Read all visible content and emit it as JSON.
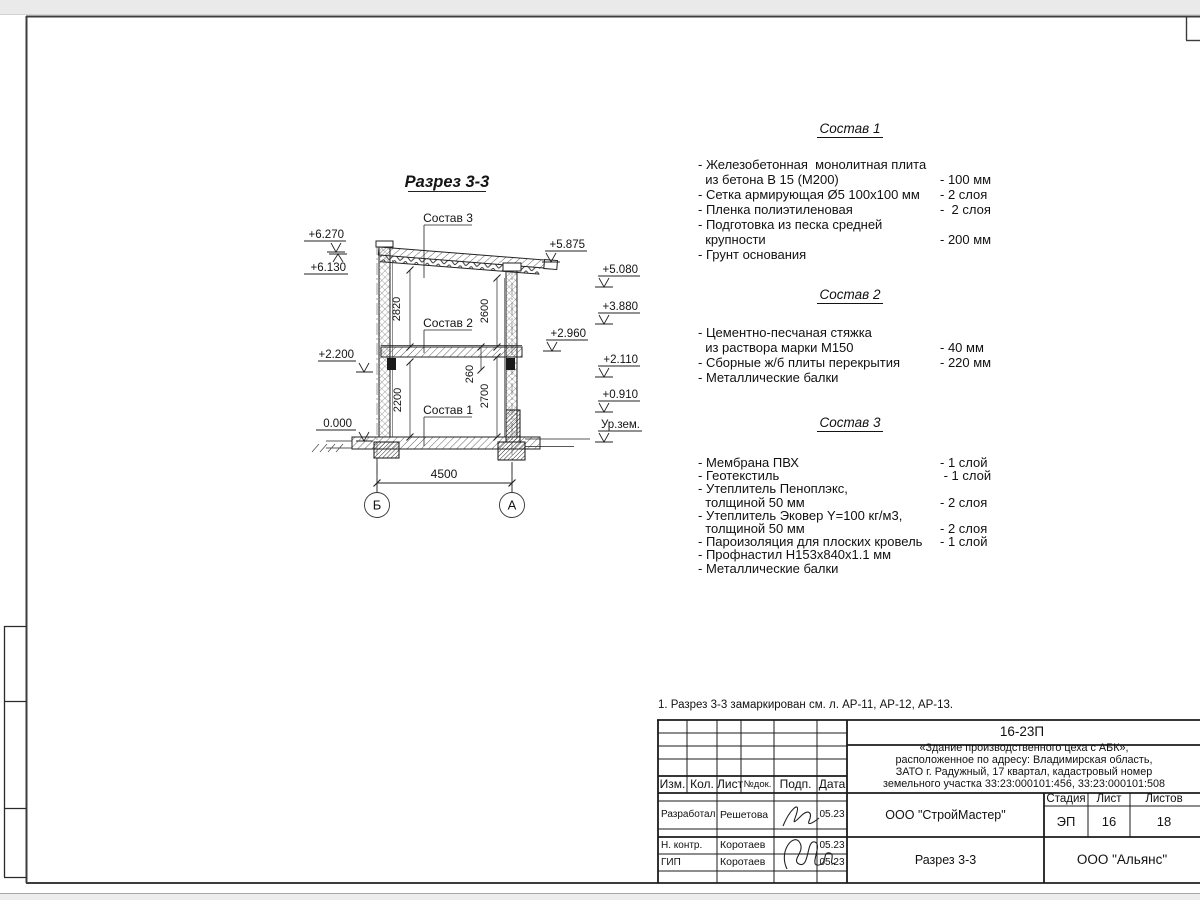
{
  "sheet": {
    "note": "1. Разрез 3-3 замаркирован см. л. АР-11, АР-12, АР-13."
  },
  "drawing": {
    "title": "Разрез 3-3",
    "labels": {
      "sostav1": "Состав 1",
      "sostav2": "Состав 2",
      "sostav3": "Состав 3"
    },
    "dims": {
      "span": "4500",
      "upper_left": "2820",
      "upper_right": "2600",
      "lower_left": "2200",
      "lower_right": "2700",
      "slab": "260"
    },
    "elevations_left": [
      "+6.270",
      "+6.130",
      "+2.200",
      "0.000"
    ],
    "elevations_right": [
      "+5.875",
      "+5.080",
      "+3.880",
      "+2.960",
      "+2.110",
      "+0.910",
      "Ур.зем."
    ],
    "axes": [
      "Б",
      "А"
    ]
  },
  "compositions": [
    {
      "title": "Состав 1",
      "lines": [
        {
          "t": "- Железобетонная  монолитная плита",
          "v": ""
        },
        {
          "t": "  из бетона В 15 (М200)",
          "v": "- 100 мм"
        },
        {
          "t": "- Сетка армирующая Ø5 100х100 мм",
          "v": "- 2 слоя"
        },
        {
          "t": "- Пленка полиэтиленовая",
          "v": "-  2 слоя"
        },
        {
          "t": "- Подготовка из песка средней",
          "v": ""
        },
        {
          "t": "  крупности",
          "v": "- 200 мм"
        },
        {
          "t": "- Грунт основания",
          "v": ""
        }
      ]
    },
    {
      "title": "Состав 2",
      "lines": [
        {
          "t": "- Цементно-песчаная стяжка",
          "v": ""
        },
        {
          "t": "  из раствора марки М150",
          "v": "- 40 мм"
        },
        {
          "t": "- Сборные ж/б плиты перекрытия",
          "v": "- 220 мм"
        },
        {
          "t": "- Металлические балки",
          "v": ""
        }
      ]
    },
    {
      "title": "Состав 3",
      "lines": [
        {
          "t": "- Мембрана ПВХ",
          "v": "- 1 слой"
        },
        {
          "t": "- Геотекстиль",
          "v": " - 1 слой"
        },
        {
          "t": "- Утеплитель Пеноплэкс,",
          "v": ""
        },
        {
          "t": "  толщиной 50 мм",
          "v": "- 2 слоя"
        },
        {
          "t": "- Утеплитель Эковер Y=100 кг/м3,",
          "v": ""
        },
        {
          "t": "  толщиной 50 мм",
          "v": "- 2 слоя"
        },
        {
          "t": "- Пароизоляция для плоских кровель",
          "v": "- 1 слой"
        },
        {
          "t": "- Профнастил Н153х840х1.1 мм",
          "v": ""
        },
        {
          "t": "- Металлические балки",
          "v": ""
        }
      ]
    }
  ],
  "titleblock": {
    "doc_number": "16-23П",
    "project": "«Здание производственного цеха с АБК»,\nрасположенное по адресу: Владимирская область,\nЗАТО г. Радужный, 17 квартал, кадастровый номер\nземельного участка 33:23:000101:456, 33:23:000101:508",
    "columns": [
      "Изм.",
      "Кол.",
      "Лист",
      "№док.",
      "Подп.",
      "Дата"
    ],
    "rows": [
      {
        "role": "Разработал",
        "name": "Решетова",
        "date": "05.23"
      },
      {
        "role": "Н. контр.",
        "name": "Коротаев",
        "date": "05.23"
      },
      {
        "role": "ГИП",
        "name": "Коротаев",
        "date": "05.23"
      }
    ],
    "org": "ООО \"СтройМастер\"",
    "stage_label": "Стадия",
    "stage": "ЭП",
    "sheet_label": "Лист",
    "sheet": "16",
    "sheets_label": "Листов",
    "sheets": "18",
    "section_title": "Разрез 3-3",
    "customer": "ООО \"Альянс\""
  }
}
